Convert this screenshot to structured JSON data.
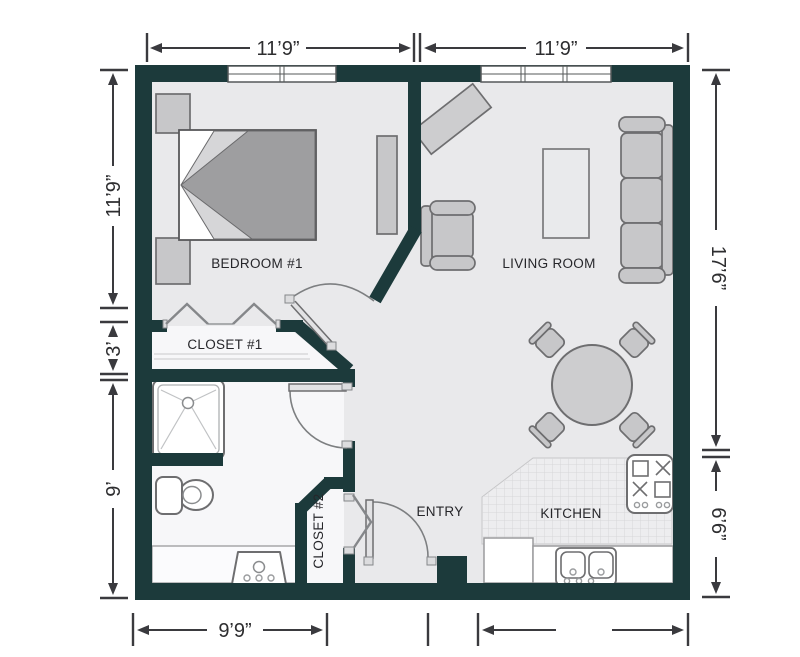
{
  "plan_title": "one-bedroom apartment floor plan",
  "rooms": {
    "bedroom": "BEDROOM #1",
    "living_room": "LIVING ROOM",
    "closet1": "CLOSET #1",
    "closet2": "CLOSET #2",
    "entry": "ENTRY",
    "kitchen": "KITCHEN"
  },
  "dimensions": {
    "top_left": "11’9”",
    "top_right": "11’9”",
    "left_upper": "11’9”",
    "left_mid": "3’",
    "left_lower": "9’",
    "right_upper": "17’6”",
    "right_lower": "6’6”",
    "bottom_left": "9’9”",
    "bottom_right": ""
  },
  "colors": {
    "background": "#ffffff",
    "wall": "#1c3a3b",
    "floor": "#e9e9eb",
    "floor_light": "#f7f7f9",
    "tile": "#ededef",
    "furniture": "#c7c7c9",
    "furniture_dark": "#9e9ea0",
    "outline": "#6e6e70",
    "dimension": "#3a3a3e"
  },
  "fixture_icons": [
    "bed-icon",
    "nightstand-icon",
    "dresser-icon",
    "media-console-icon",
    "armchair-icon",
    "coffee-table-icon",
    "sofa-icon",
    "dining-table-icon",
    "dining-chair-icon",
    "shower-icon",
    "toilet-icon",
    "vanity-sink-icon",
    "kitchen-sink-icon",
    "stove-icon",
    "window-icon",
    "door-swing-icon",
    "bifold-door-icon"
  ]
}
